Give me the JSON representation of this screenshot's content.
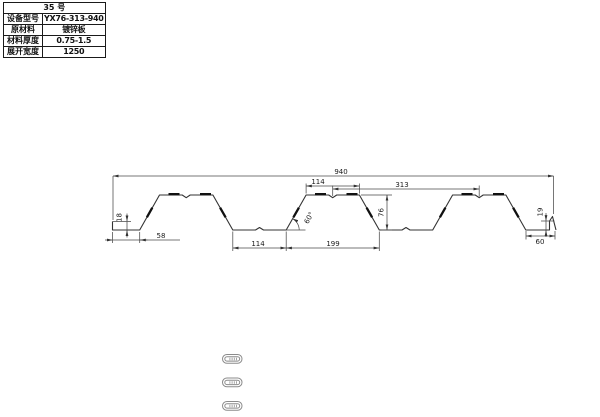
{
  "table": {
    "header": "35 号",
    "rows": [
      {
        "label": "设备型号",
        "value": "YX76-313-940"
      },
      {
        "label": "原材料",
        "value": "镀锌板"
      },
      {
        "label": "材料厚度",
        "value": "0.75-1.5"
      },
      {
        "label": "展开宽度",
        "value": "1250"
      }
    ]
  },
  "drawing": {
    "profile_name": "YX76-313-940",
    "dims": {
      "total_width": "940",
      "top_flange": "114",
      "pitch": "313",
      "left_flat": "58",
      "valley": "114",
      "rib_base": "199",
      "rib_height": "76",
      "left_lip": "18",
      "right_lip": "19",
      "right_flat": "60",
      "web_angle": "60°"
    }
  },
  "colors": {
    "line": "#333333",
    "dimension": "#4a4a4a",
    "background": "#ffffff"
  }
}
